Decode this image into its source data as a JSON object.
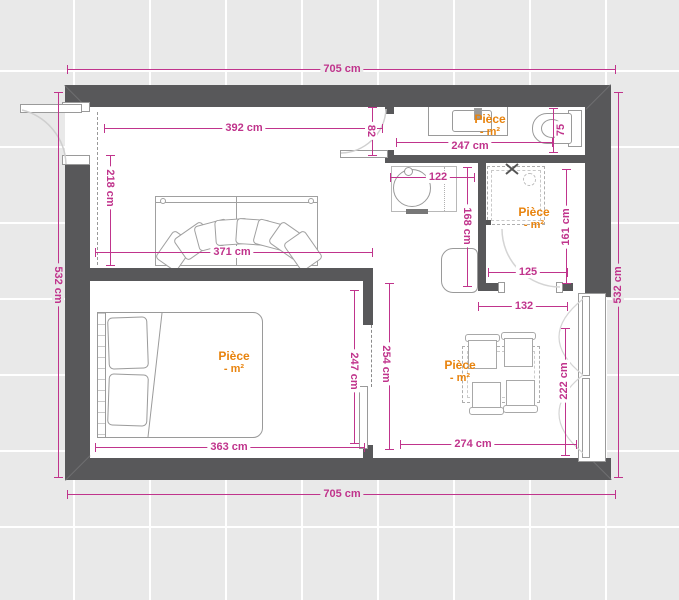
{
  "plan": {
    "type": "apartment-floor-plan",
    "colors": {
      "wall": "#58585a",
      "dimension": "#c0348c",
      "room_label": "#e8830d",
      "floor": "#ffffff",
      "background": "#e9e9e9"
    },
    "exterior_dimensions": {
      "top": "705 cm",
      "bottom": "705 cm",
      "left": "532 cm",
      "right": "532 cm"
    },
    "dims": {
      "living_top": "392 cm",
      "living_left": "218 cm",
      "living_bottom": "371 cm",
      "living_door": "82",
      "bath_width": "247 cm",
      "bath_depth": "75",
      "basin": "122",
      "hall_height": "168 cm",
      "shower_height": "161 cm",
      "shower_width": "125",
      "shower_outer": "132",
      "bedroom_bottom": "363 cm",
      "bedroom_right": "247 cm",
      "bedroom_opening": "254 cm",
      "dining_bottom": "274 cm",
      "window_width": "222 cm"
    },
    "labels": {
      "bathroom": {
        "name": "Pièce",
        "area": "- m²"
      },
      "shower": {
        "name": "Pièce",
        "area": "- m²"
      },
      "bedroom": {
        "name": "Pièce",
        "area": "- m²"
      },
      "dining": {
        "name": "Pièce",
        "area": "- m²"
      }
    }
  }
}
